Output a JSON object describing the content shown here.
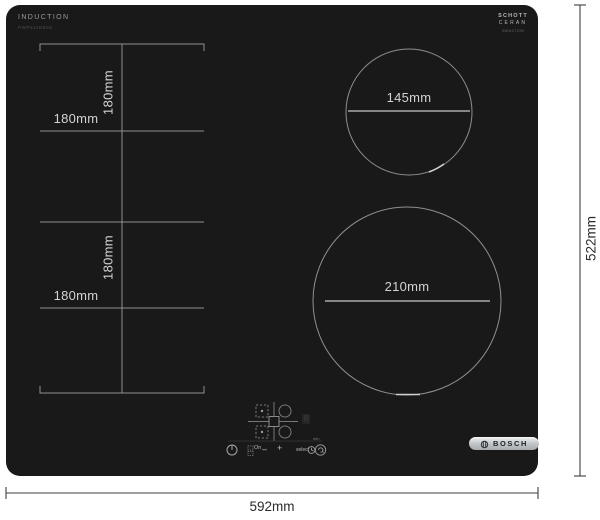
{
  "hob": {
    "type_label": "INDUCTION",
    "model_label": "PWP611BB5E",
    "glass_brand": {
      "line1": "SCHOTT",
      "line2": "CERAN",
      "line3": "INDUCTION"
    },
    "logo_text": "BOSCH",
    "surface_color": "#191919"
  },
  "dimension_labels": {
    "overall_width": "592mm",
    "overall_height": "522mm",
    "back_left_zone_height": "180mm",
    "back_left_zone_width": "180mm",
    "front_left_zone_height": "180mm",
    "front_left_zone_width": "180mm",
    "back_right_zone_diameter": "145mm",
    "front_right_zone_diameter": "210mm"
  },
  "controls": {
    "on_label": "On",
    "minus_label": "–",
    "plus_label": "+",
    "select_label": "select",
    "min_label": "min",
    "display_value": "8"
  },
  "colors": {
    "zone_line": "#8f8f8f",
    "zone_text": "#d4d4d4",
    "dim_line": "#3f3f3f",
    "dim_text": "#2b2b2b",
    "logo_plate_silver": "#c3c7ca"
  }
}
